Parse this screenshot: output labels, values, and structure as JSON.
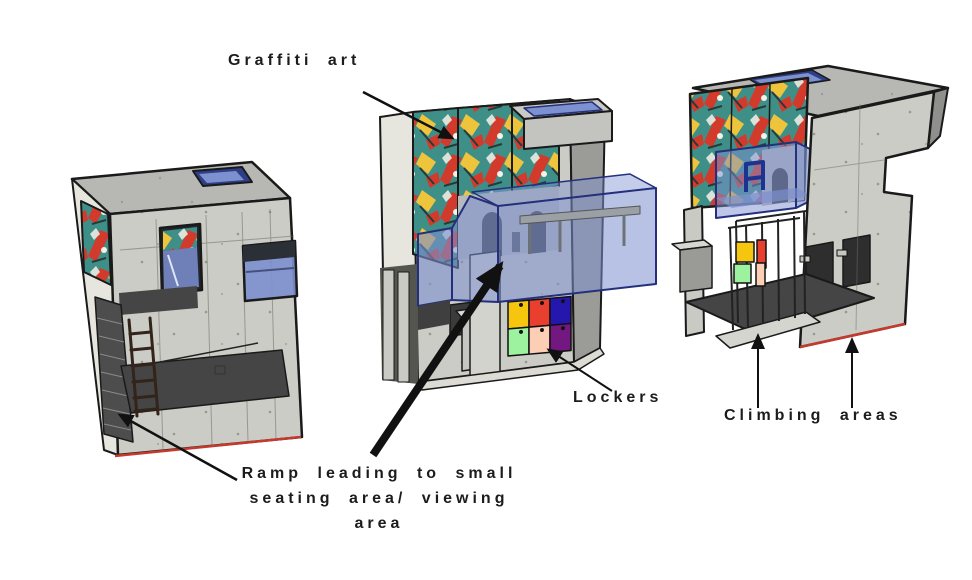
{
  "canvas": {
    "width": 972,
    "height": 580,
    "background": "#ffffff"
  },
  "annotations": {
    "graffiti": {
      "label": "Graffiti art"
    },
    "lockers": {
      "label": "Lockers"
    },
    "climbing": {
      "label": "Climbing areas"
    },
    "ramp": {
      "lines": [
        "Ramp leading to small",
        "seating area/ viewing",
        "area"
      ]
    }
  },
  "colors": {
    "text": "#1c1c1c",
    "outline": "#1a1a1a",
    "concrete": "#cbccc5",
    "concrete_light": "#d8d9d2",
    "concrete_shade": "#9b9c98",
    "roof": "#b7b8b3",
    "side_light": "#e7e6de",
    "floor_dark": "#454545",
    "glass_blue": "#7d90cf",
    "glass_frame": "#24307c",
    "stool_blue": "#1d3390",
    "bench_gray": "#9aa0a6",
    "mural_gray": "#b6b9bd",
    "mural_dark": "#3c4046",
    "ladder_brown": "#33241b",
    "base_red": "#c53a2c",
    "graffiti_teal": "#3f8f89",
    "graffiti_red": "#d23b2c",
    "graffiti_yellow": "#eec43c",
    "graffiti_white": "#f5f2e8",
    "locker_yellow": "#f6c50e",
    "locker_red": "#e93f2e",
    "locker_blue": "#2517ae",
    "locker_green": "#9df2a0",
    "locker_peach": "#fbceb5",
    "locker_purple": "#741881"
  }
}
